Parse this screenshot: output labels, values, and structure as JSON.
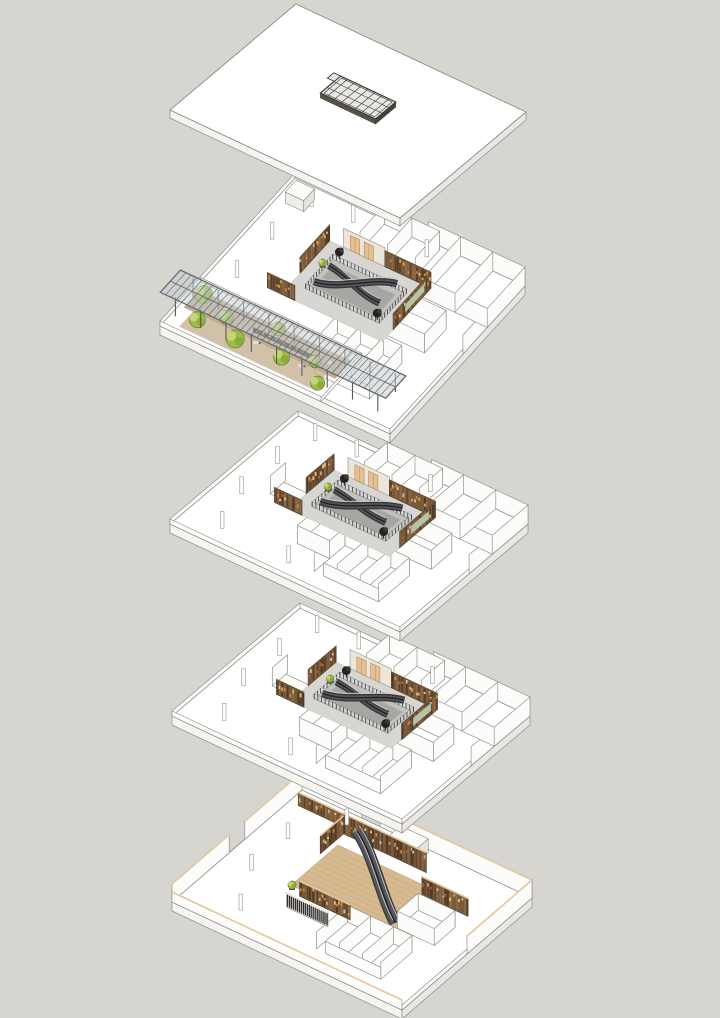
{
  "diagram": {
    "type": "exploded-axonometric-architecture-diagram",
    "layer_count": 5,
    "escalators_per_floor": 2,
    "layers": [
      {
        "id": "roof",
        "label": "Roof slab with central skylight grid",
        "features": [
          "skylight-grid"
        ]
      },
      {
        "id": "upper-floor",
        "label": "Top floor with escalator atrium, terrace deck, glazed canopy and planting",
        "features": [
          "atrium-escalators",
          "wood-display-walls",
          "terrace-deck",
          "glass-canopy",
          "planting",
          "rooms"
        ]
      },
      {
        "id": "mid-floor-2",
        "label": "Intermediate floor with escalator atrium and display walls",
        "features": [
          "atrium-escalators",
          "wood-display-walls",
          "rooms"
        ]
      },
      {
        "id": "mid-floor-1",
        "label": "Intermediate floor with escalator atrium and display walls",
        "features": [
          "atrium-escalators",
          "wood-display-walls",
          "rooms"
        ]
      },
      {
        "id": "ground-floor",
        "label": "Ground floor with timber floor, shelving walls, slatted screen and escalators",
        "features": [
          "escalators",
          "timber-floor",
          "shelving-walls",
          "slatted-screen",
          "rooms"
        ]
      }
    ],
    "skylight": {
      "rows": 3,
      "cols": 8
    }
  },
  "palette": {
    "background": "#d7d5d0",
    "plate_top": "#ffffff",
    "plate_side_sw": "#f5f4f1",
    "plate_side_se": "#e9e7e2",
    "outline": "#8f8c87",
    "wall_face": "#fcfcfa",
    "wall_shade": "#e9e7e3",
    "atrium_floor": "#d7d6d2",
    "atrium_void": "#c2c1bd",
    "escalator_dark": "#38383c",
    "escalator_mid": "#56565b",
    "escalator_core": "#232327",
    "handrail": "#c9c9c7",
    "wood_base": "#775a3e",
    "wood_tones": [
      "#5c432d",
      "#7a5a3c",
      "#8d6a47",
      "#4d3a27"
    ],
    "shelf_items": [
      "#c8883f",
      "#d9a45c",
      "#b5622c",
      "#e0c28f"
    ],
    "wood_cap": "#e2c79b",
    "cream_wall": "#ebe5da",
    "door_tan": "#e4c094",
    "door_frame": "#b28c5c",
    "rail_glass": "#d6dadb",
    "canopy_glass": "#c7ced2",
    "canopy_frame": "#686c6e",
    "deck_a": "#b59e7d",
    "deck_b": "#c7b293",
    "timber_floor": "#d6ba8f",
    "plank_line": "#c1a378",
    "plant_green": "#9ebf45",
    "plant_light": "#c3d675",
    "plant_stroke": "#5f7c2b",
    "plant_dark": "#24231f",
    "slat_bar": "#2c2b28",
    "display_panel": "#b7c2a6",
    "skylight_frame": "#3f3d38",
    "skylight_glass": "#e8e7e4",
    "skylight_side": "#55524c",
    "counter_dark": "#3b352c"
  }
}
